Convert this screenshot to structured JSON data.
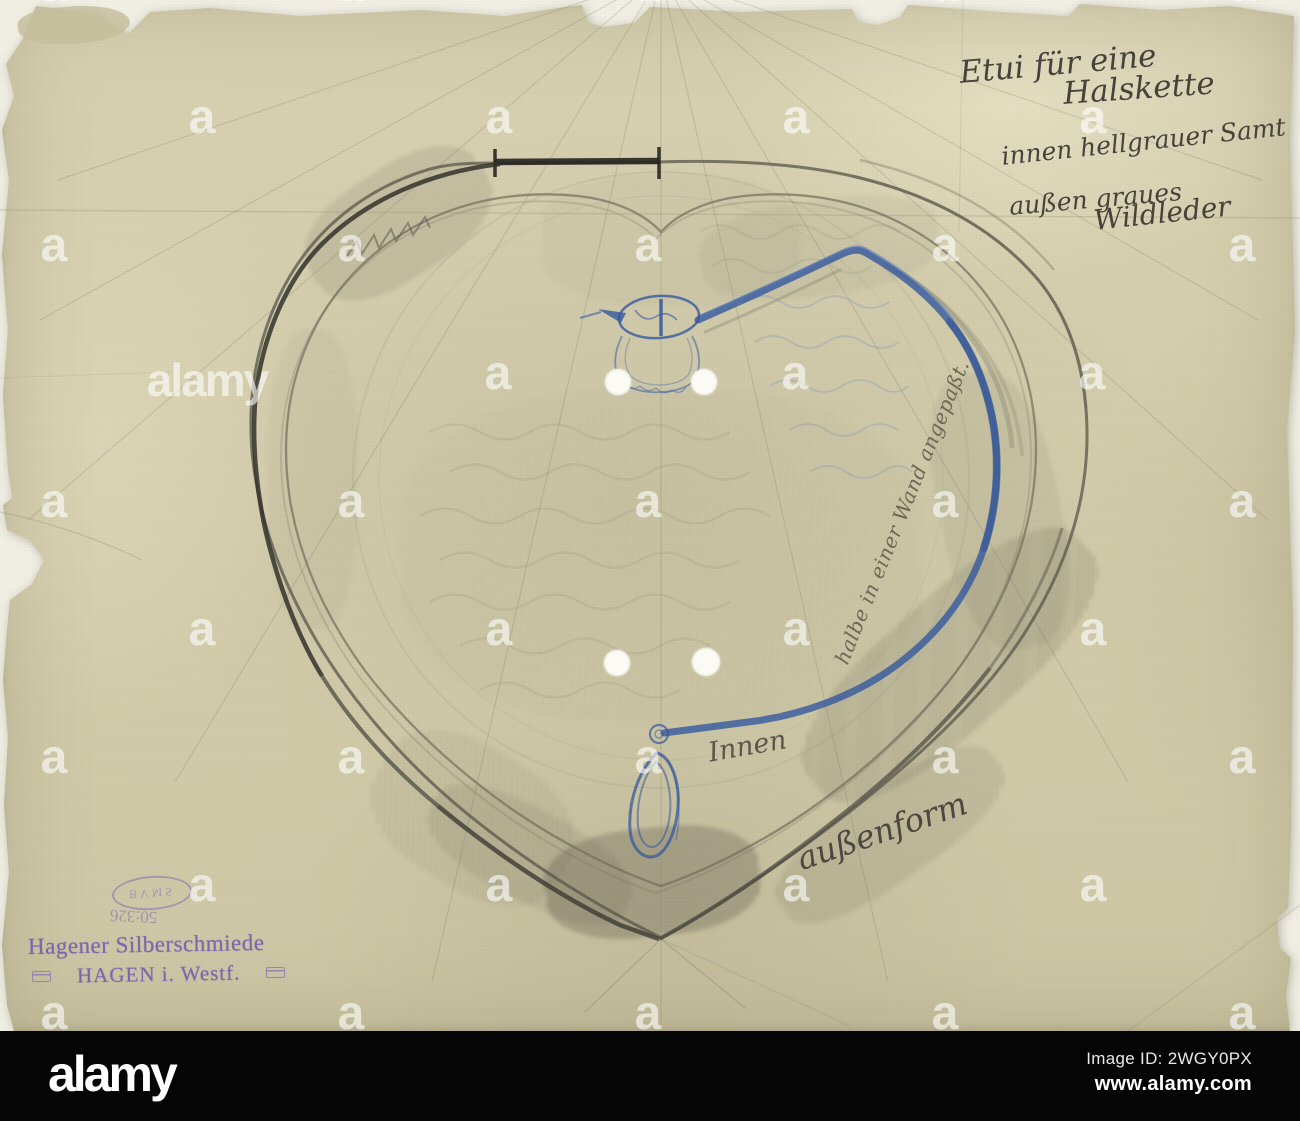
{
  "annotations": {
    "title_line1": "Etui für eine",
    "title_line2": "Halskette",
    "material_line1": "innen hellgrauer Samt",
    "material_line2": "außen graues",
    "material_line3": "Wildleder",
    "note_along_curve": "halbe in einer Wand angepaßt.",
    "note_inner": "Innen",
    "note_outer_form": "außenform"
  },
  "stamp": {
    "maker_line1": "Hagener Silberschmiede",
    "maker_line2": "HAGEN i. Westf.",
    "oval_letters": "BVMS",
    "inventory_number": "50:326",
    "ink_color": "#7d66ab"
  },
  "drawing": {
    "subject": "heart-shaped necklace case outline with blue necklace sketch",
    "pencil_color": "#45423a",
    "blue_pencil_color": "#35599f",
    "paper_color": "#d3cdac"
  },
  "watermark": {
    "tile_letter": "a",
    "brand": "alamy",
    "image_id_line": "Image ID: 2WGY0PX",
    "url": "www.alamy.com",
    "tiles": {
      "rows": [
        {
          "y": -14,
          "xs": [
            54,
            351,
            648,
            945,
            1242
          ]
        },
        {
          "y": 118,
          "xs": [
            202,
            499,
            796,
            1093
          ]
        },
        {
          "y": 246,
          "xs": [
            54,
            351,
            648,
            945,
            1242
          ]
        },
        {
          "y": 374,
          "xs": [
            498,
            795,
            1092
          ]
        },
        {
          "y": 502,
          "xs": [
            54,
            351,
            648,
            945,
            1242
          ]
        },
        {
          "y": 630,
          "xs": [
            202,
            499,
            796,
            1093
          ]
        },
        {
          "y": 758,
          "xs": [
            54,
            351,
            648,
            945,
            1242
          ]
        },
        {
          "y": 886,
          "xs": [
            202,
            499,
            796,
            1093
          ]
        },
        {
          "y": 1014,
          "xs": [
            54,
            351,
            648,
            945,
            1242
          ]
        }
      ],
      "words": [
        {
          "x": 207,
          "y": 380
        }
      ]
    }
  }
}
